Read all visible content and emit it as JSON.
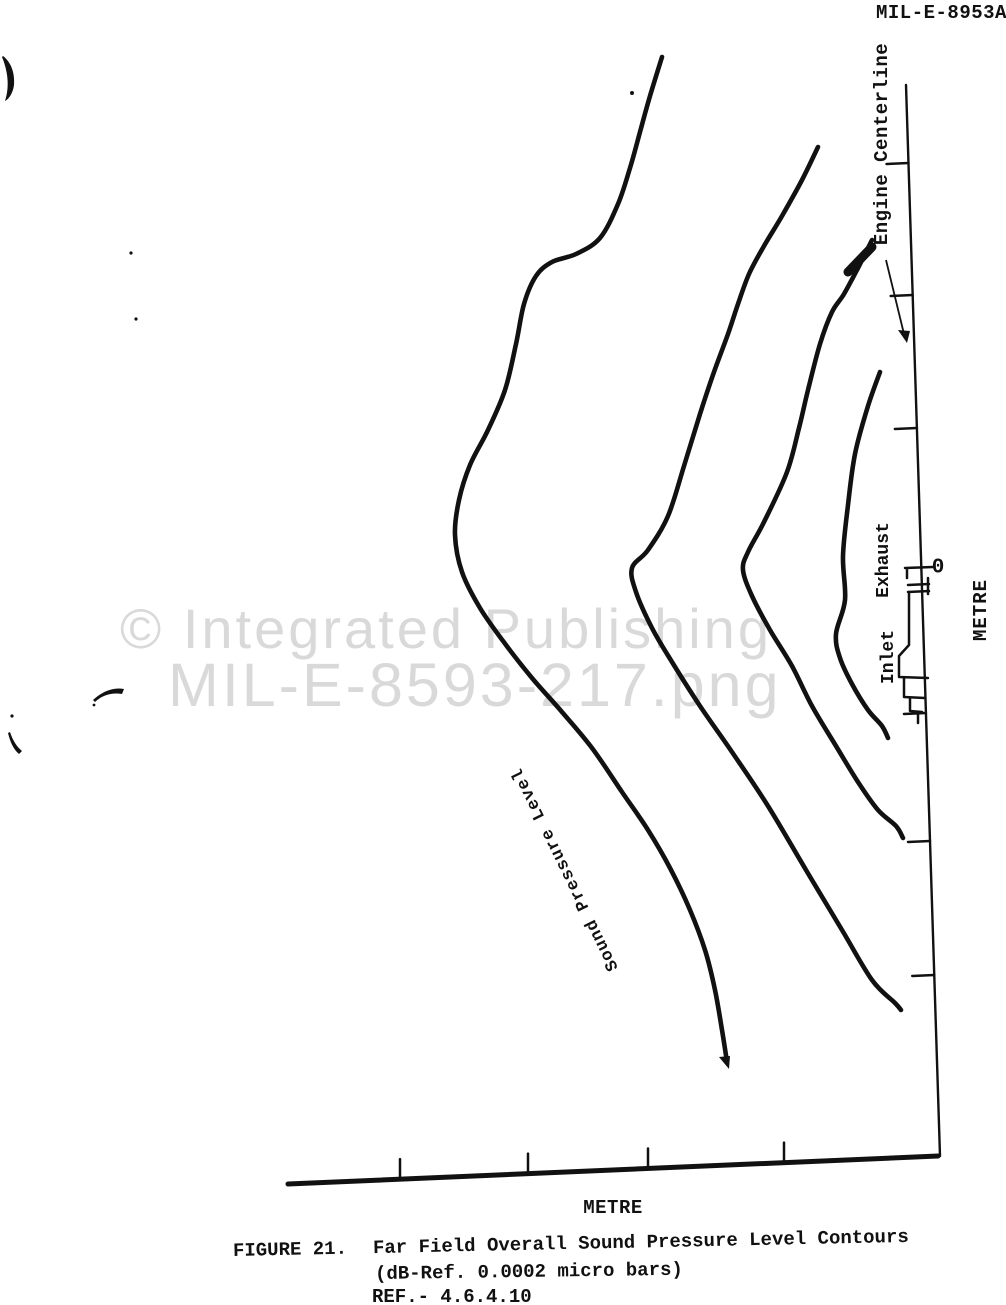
{
  "doc_number": "MIL-E-8953A",
  "watermark": {
    "line1": "© Integrated Publishing",
    "line2": "MIL-E-8593-217.png",
    "color": "#d9d9d9"
  },
  "figure_labels": {
    "engine_centerline": "Engine Centerline",
    "exhaust": "Exhaust",
    "inlet": "Inlet",
    "station_zero": "0",
    "metre_vertical": "METRE",
    "metre_horizontal": "METRE",
    "contour_label": "Sound Pressure Level"
  },
  "caption": {
    "figure_label": "FIGURE 21.",
    "title": "Far Field Overall Sound Pressure Level Contours",
    "subtitle": "(dB-Ref. 0.0002 micro bars)",
    "reference": "REF.- 4.6.4.10"
  },
  "chart_data": {
    "type": "contour",
    "title": "Far Field Overall Sound Pressure Level Contours",
    "subtitle": "(dB-Ref. 0.0002 micro bars)",
    "xlabel": "METRE",
    "ylabel": "METRE",
    "axis_tick_labels": [
      "0"
    ],
    "legend": "none",
    "note": "Scanned figure rotated 90 degrees on page: engine centerline axis runs vertically with station 0 at the engine; four unlabeled overall sound pressure level contour lobes fan out from the engine inlet/exhaust; outermost contour carries the label 'Sound Pressure Level'.",
    "ink_color": "#111111",
    "contour_stroke_width": 4.6,
    "contours": [
      {
        "name": "contour-1-outermost",
        "points": [
          [
            662,
            57
          ],
          [
            650,
            96
          ],
          [
            640,
            132
          ],
          [
            630,
            168
          ],
          [
            618,
            204
          ],
          [
            600,
            238
          ],
          [
            576,
            254
          ],
          [
            552,
            262
          ],
          [
            536,
            276
          ],
          [
            524,
            304
          ],
          [
            516,
            344
          ],
          [
            505,
            390
          ],
          [
            488,
            430
          ],
          [
            470,
            465
          ],
          [
            459,
            500
          ],
          [
            455,
            535
          ],
          [
            462,
            572
          ],
          [
            480,
            608
          ],
          [
            506,
            645
          ],
          [
            532,
            678
          ],
          [
            562,
            712
          ],
          [
            592,
            748
          ],
          [
            622,
            792
          ],
          [
            648,
            830
          ],
          [
            670,
            868
          ],
          [
            690,
            910
          ],
          [
            705,
            950
          ],
          [
            715,
            990
          ],
          [
            722,
            1030
          ],
          [
            727,
            1062
          ]
        ]
      },
      {
        "name": "contour-2",
        "points": [
          [
            818,
            147
          ],
          [
            802,
            180
          ],
          [
            782,
            216
          ],
          [
            764,
            246
          ],
          [
            749,
            274
          ],
          [
            738,
            304
          ],
          [
            728,
            334
          ],
          [
            714,
            372
          ],
          [
            700,
            414
          ],
          [
            684,
            466
          ],
          [
            668,
            516
          ],
          [
            648,
            550
          ],
          [
            632,
            568
          ],
          [
            636,
            592
          ],
          [
            652,
            628
          ],
          [
            672,
            662
          ],
          [
            700,
            706
          ],
          [
            732,
            752
          ],
          [
            768,
            806
          ],
          [
            806,
            870
          ],
          [
            842,
            930
          ],
          [
            872,
            980
          ],
          [
            895,
            1003
          ],
          [
            901,
            1010
          ]
        ]
      },
      {
        "name": "contour-3",
        "points": [
          [
            872,
            240
          ],
          [
            858,
            268
          ],
          [
            844,
            294
          ],
          [
            832,
            312
          ],
          [
            820,
            344
          ],
          [
            808,
            390
          ],
          [
            799,
            428
          ],
          [
            787,
            472
          ],
          [
            764,
            522
          ],
          [
            748,
            552
          ],
          [
            743,
            570
          ],
          [
            752,
            596
          ],
          [
            770,
            630
          ],
          [
            792,
            666
          ],
          [
            812,
            706
          ],
          [
            836,
            746
          ],
          [
            858,
            782
          ],
          [
            878,
            810
          ],
          [
            896,
            826
          ],
          [
            903,
            838
          ]
        ]
      },
      {
        "name": "contour-4-innermost",
        "points": [
          [
            880,
            372
          ],
          [
            868,
            406
          ],
          [
            855,
            454
          ],
          [
            848,
            505
          ],
          [
            843,
            556
          ],
          [
            845,
            600
          ],
          [
            836,
            634
          ],
          [
            840,
            658
          ],
          [
            852,
            684
          ],
          [
            868,
            710
          ],
          [
            882,
            726
          ],
          [
            888,
            738
          ]
        ]
      }
    ],
    "bottom_axis": {
      "x1": 288,
      "y1": 1184,
      "x2": 938,
      "y2": 1156,
      "ticks_x": [
        400,
        528,
        648,
        784
      ],
      "tick_len": 20,
      "stroke_width": 5
    },
    "centerline_axis": {
      "x1": 906,
      "y1": 85,
      "x2": 940,
      "y2": 1156,
      "ticks_y": [
        163,
        295,
        428,
        713,
        841,
        975
      ],
      "tick_len": 22,
      "stroke_width": 2.4
    }
  }
}
